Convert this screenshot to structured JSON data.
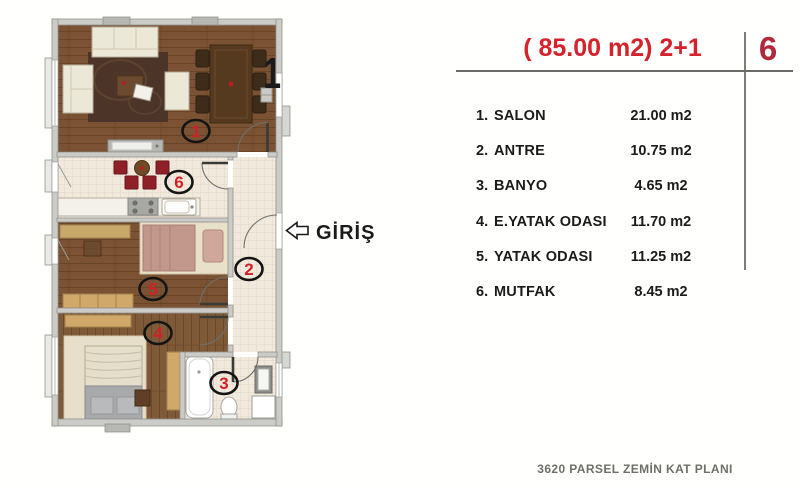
{
  "legend": {
    "title": "( 85.00 m2) 2+1",
    "unit_number": "6",
    "rows": [
      {
        "num": "1.",
        "name": "SALON",
        "area": "21.00 m2"
      },
      {
        "num": "2.",
        "name": "ANTRE",
        "area": "10.75 m2"
      },
      {
        "num": "3.",
        "name": "BANYO",
        "area": "4.65 m2"
      },
      {
        "num": "4.",
        "name": "E.YATAK ODASI",
        "area": "11.70 m2"
      },
      {
        "num": "5.",
        "name": "YATAK ODASI",
        "area": "11.25 m2"
      },
      {
        "num": "6.",
        "name": "MUTFAK",
        "area": "8.45 m2"
      }
    ],
    "footer": "3620 PARSEL ZEMİN KAT PLANI"
  },
  "plan": {
    "entrance_label": "GİRİŞ",
    "corner_digit": "1",
    "markers": [
      {
        "n": "1"
      },
      {
        "n": "2"
      },
      {
        "n": "3"
      },
      {
        "n": "4"
      },
      {
        "n": "5"
      },
      {
        "n": "6"
      }
    ],
    "colors": {
      "accent_red": "#d4232c",
      "unit_red": "#b02a3c",
      "marker_red": "#d22027",
      "wood": "#7b5334",
      "wood_dark": "#4c3428",
      "tile": "#f0e9dc",
      "wall": "#cbcbc7"
    }
  }
}
